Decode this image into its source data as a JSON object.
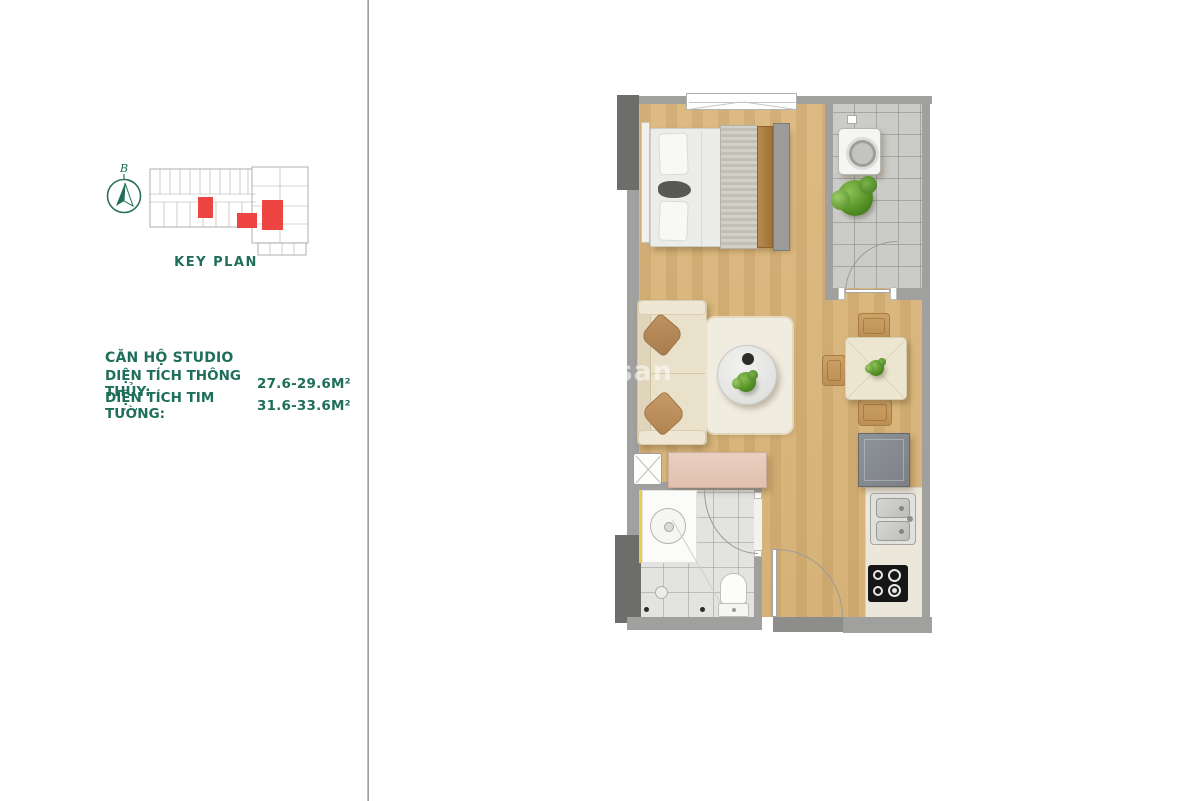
{
  "left_panel": {
    "compass": {
      "label": "B"
    },
    "key_plan": {
      "title": "KEY PLAN"
    },
    "unit_info": {
      "title": "CĂN HỘ STUDIO",
      "rows": [
        {
          "label": "DIỆN TÍCH THÔNG THỦY:",
          "value": "27.6-29.6M²"
        },
        {
          "label": "DIỆN TÍCH TIM TƯỜNG:",
          "value": "31.6-33.6M²"
        }
      ]
    }
  },
  "colors": {
    "accent_green": "#1e6e59",
    "highlight_red": "#ef4542",
    "wall_gray": "#a0a09e",
    "wall_dark_gray": "#6d6d6b",
    "wood_floor": "#d9b77e",
    "balcony_tile": "#cbcbc7",
    "bathroom_tile": "#e3e3e1"
  },
  "floor_plan": {
    "elements": [
      "window",
      "bed",
      "washing-machine",
      "balcony-plant",
      "balcony-door",
      "sofa",
      "rug",
      "coffee-table",
      "coffee-table-plant",
      "dining-table",
      "dining-chairs",
      "refrigerator",
      "kitchen-sink",
      "cooktop",
      "technical-shaft",
      "sideboard-cabinet",
      "bathroom-vanity",
      "bathroom-sink",
      "toilet",
      "shower-drains",
      "bathroom-door",
      "entry-door"
    ]
  },
  "watermark": {
    "text": "gsan"
  }
}
